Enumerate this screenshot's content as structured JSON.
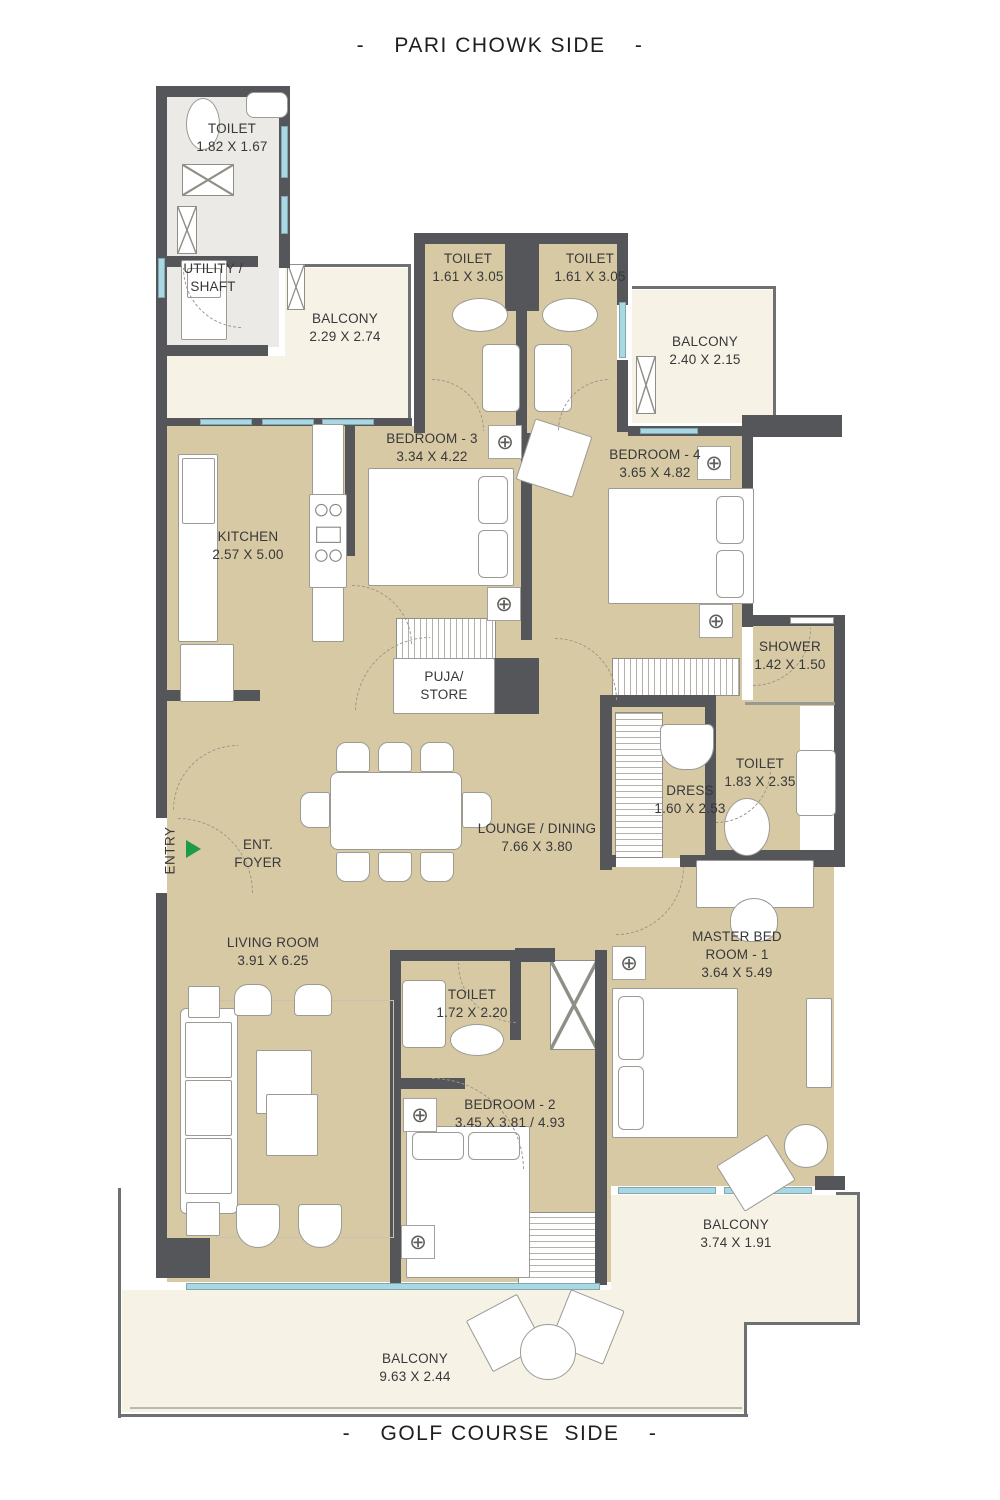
{
  "titles": {
    "top": "-    PARI CHOWK SIDE    -",
    "bottom": "-    GOLF COURSE  SIDE    -"
  },
  "rooms": {
    "toilet_tl": {
      "name": "TOILET",
      "dims": "1.82 X 1.67"
    },
    "utility": {
      "name": "UTILITY /",
      "name2": "SHAFT"
    },
    "balcony_tl": {
      "name": "BALCONY",
      "dims": "2.29 X 2.74"
    },
    "toilet_b3": {
      "name": "TOILET",
      "dims": "1.61 X 3.05"
    },
    "toilet_b4": {
      "name": "TOILET",
      "dims": "1.61 X 3.05"
    },
    "balcony_tr": {
      "name": "BALCONY",
      "dims": "2.40 X 2.15"
    },
    "bedroom3": {
      "name": "BEDROOM - 3",
      "dims": "3.34 X 4.22"
    },
    "bedroom4": {
      "name": "BEDROOM - 4",
      "dims": "3.65 X 4.82"
    },
    "kitchen": {
      "name": "KITCHEN",
      "dims": "2.57 X 5.00"
    },
    "puja": {
      "name": "PUJA/",
      "name2": "STORE"
    },
    "shower": {
      "name": "SHOWER",
      "dims": "1.42 X 1.50"
    },
    "toilet_master": {
      "name": "TOILET",
      "dims": "1.83 X 2.35"
    },
    "dress": {
      "name": "DRESS",
      "dims": "1.60 X 2.53"
    },
    "lounge": {
      "name": "LOUNGE / DINING",
      "dims": "7.66 X 3.80"
    },
    "foyer": {
      "name": "ENT.",
      "name2": "FOYER"
    },
    "entry": {
      "name": "ENTRY"
    },
    "living": {
      "name": "LIVING ROOM",
      "dims": "3.91 X 6.25"
    },
    "master": {
      "name": "MASTER BED",
      "name2": "ROOM - 1",
      "dims": "3.64 X 5.49"
    },
    "toilet_bed2": {
      "name": "TOILET",
      "dims": "1.72 X 2.20"
    },
    "bedroom2": {
      "name": "BEDROOM - 2",
      "dims": "3.45 X 3.81 / 4.93"
    },
    "balcony_master": {
      "name": "BALCONY",
      "dims": "3.74 X 1.91"
    },
    "balcony_bottom": {
      "name": "BALCONY",
      "dims": "9.63 X 2.44"
    }
  },
  "icons": {
    "fan": "⊕"
  },
  "colors": {
    "wall": "#55565a",
    "room_fill": "#d7c9a4",
    "balcony_fill": "#f6f2e6",
    "wet_floor": "#ebeae6",
    "window_glass": "#a9d7e2",
    "entry_arrow_green": "#1d9b48",
    "label_text": "#38383a"
  }
}
